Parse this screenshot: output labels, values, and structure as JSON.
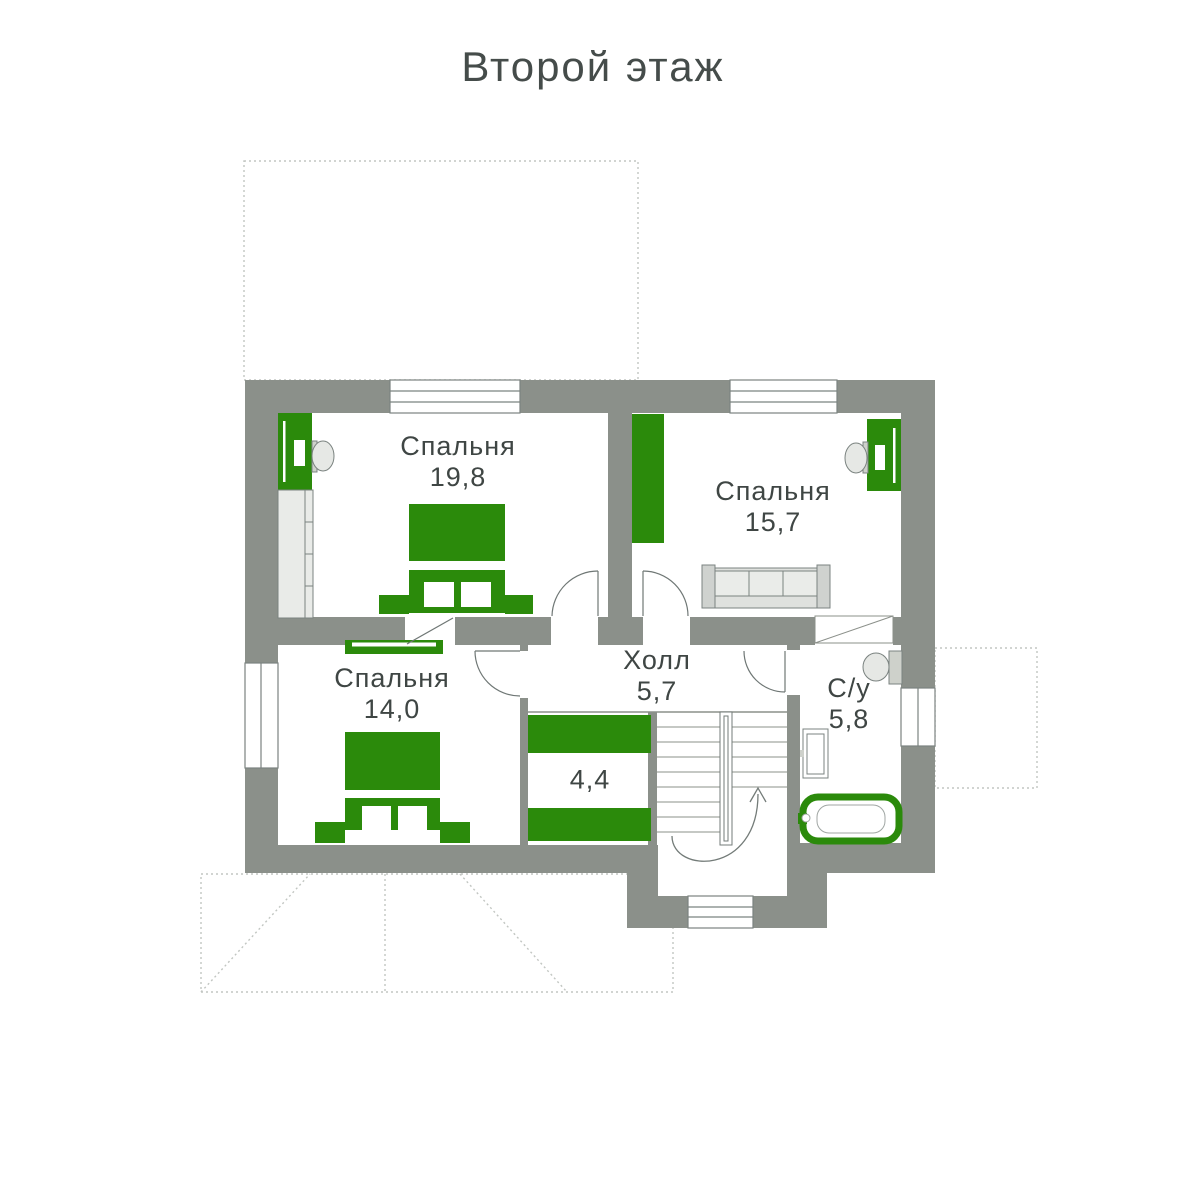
{
  "title": "Второй этаж",
  "colors": {
    "wall": "#8b908a",
    "green": "#2b8a0b",
    "text": "#3f4644",
    "furniture_light": "#e3e5e2",
    "outline": "#7b8380",
    "dash": "#c2c6c2"
  },
  "rooms": [
    {
      "name": "Спальня",
      "area": "19,8"
    },
    {
      "name": "Спальня",
      "area": "15,7"
    },
    {
      "name": "Спальня",
      "area": "14,0"
    },
    {
      "name": "Холл",
      "area": "5,7"
    },
    {
      "name": "С/у",
      "area": "5,8"
    },
    {
      "name": "",
      "area": "4,4"
    }
  ]
}
